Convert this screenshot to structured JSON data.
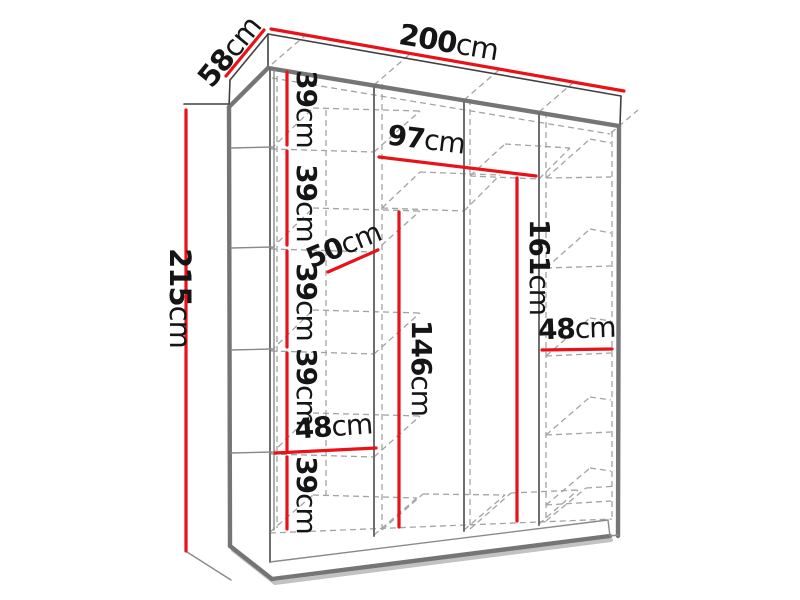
{
  "diagram": {
    "kind": "wardrobe-dimension-diagram",
    "dims": {
      "width": {
        "value": "200",
        "unit": "cm"
      },
      "depth": {
        "value": "58",
        "unit": "cm"
      },
      "height": {
        "value": "215",
        "unit": "cm"
      },
      "middle_inner_width": {
        "value": "97",
        "unit": "cm"
      },
      "shelf_depth": {
        "value": "50",
        "unit": "cm"
      },
      "left_column_width": {
        "value": "48",
        "unit": "cm"
      },
      "right_column_width": {
        "value": "48",
        "unit": "cm"
      },
      "left_hanging_height": {
        "value": "146",
        "unit": "cm"
      },
      "right_hanging_height": {
        "value": "161",
        "unit": "cm"
      },
      "shelf_spacings": [
        {
          "value": "39",
          "unit": "cm"
        },
        {
          "value": "39",
          "unit": "cm"
        },
        {
          "value": "39",
          "unit": "cm"
        },
        {
          "value": "39",
          "unit": "cm"
        },
        {
          "value": "39",
          "unit": "cm"
        }
      ]
    },
    "colors": {
      "dimension_red": "#e8121a",
      "outline_dark": "#404040",
      "panel_gray": "#757575",
      "hidden_gray": "#a3a3a3",
      "text_color": "#151515",
      "background": "#ffffff"
    }
  }
}
